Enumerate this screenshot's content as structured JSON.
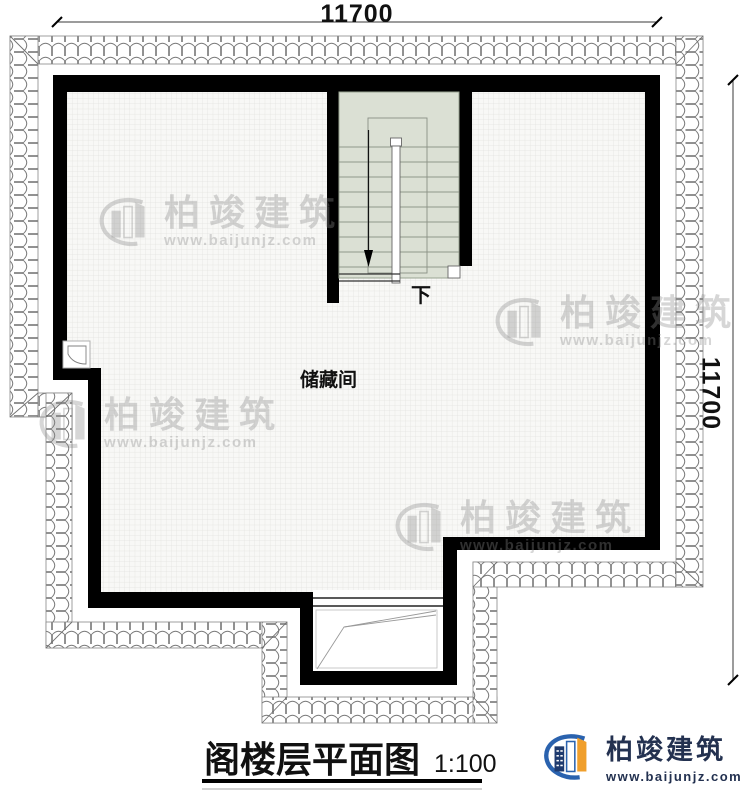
{
  "dimensions": {
    "top": "11700",
    "right": "11700"
  },
  "rooms": {
    "storage_label": "储藏间"
  },
  "stair": {
    "direction_label": "下"
  },
  "title_block": {
    "title": "阁楼层平面图",
    "scale": "1:100"
  },
  "logo": {
    "name": "柏竣建筑",
    "url": "www.baijunjz.com"
  },
  "watermark": {
    "name": "柏竣建筑",
    "url": "www.baijunjz.com"
  },
  "colors": {
    "wall": "#000000",
    "stair_fill": "#dbe0d4",
    "floor_grid_line": "#e2e2de",
    "tile_line": "#767676",
    "logo_navy": "#233150",
    "logo_blue": "#2a62ae",
    "logo_orange": "#f09f2c"
  }
}
